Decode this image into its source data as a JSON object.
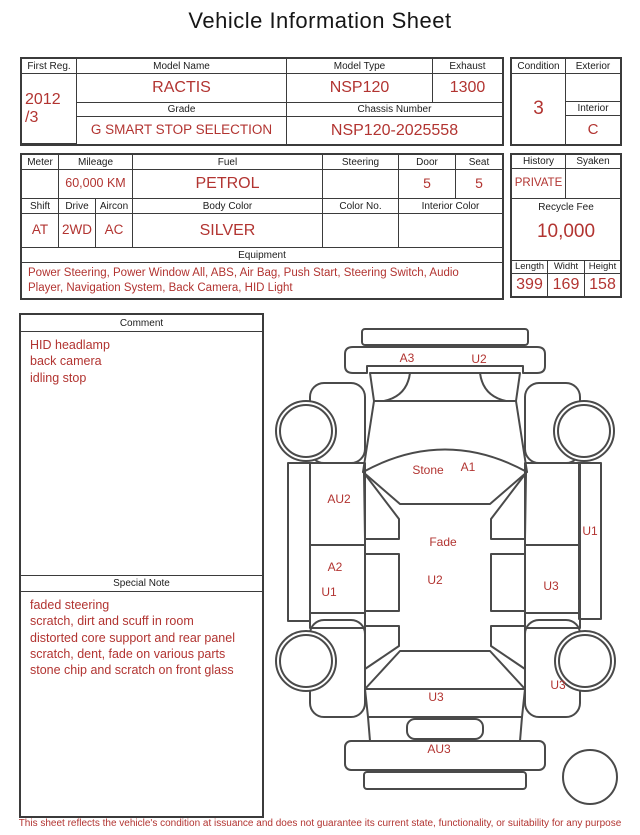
{
  "title": "Vehicle Information Sheet",
  "table1": {
    "first_reg": {
      "label": "First Reg.",
      "value": "2012\n/3"
    },
    "model_name": {
      "label": "Model Name",
      "value": "RACTIS"
    },
    "model_type": {
      "label": "Model Type",
      "value": "NSP120"
    },
    "exhaust": {
      "label": "Exhaust",
      "value": "1300"
    },
    "grade": {
      "label": "Grade",
      "value": "G SMART STOP SELECTION"
    },
    "chassis_number": {
      "label": "Chassis Number",
      "value": "NSP120-2025558"
    },
    "condition": {
      "label": "Condition",
      "value": "3"
    },
    "exterior": {
      "label": "Exterior",
      "value": ""
    },
    "interior": {
      "label": "Interior",
      "value": "C"
    }
  },
  "table2": {
    "meter": {
      "label": "Meter",
      "value": ""
    },
    "mileage": {
      "label": "Mileage",
      "value": "60,000 KM"
    },
    "fuel": {
      "label": "Fuel",
      "value": "PETROL"
    },
    "steering": {
      "label": "Steering",
      "value": ""
    },
    "door": {
      "label": "Door",
      "value": "5"
    },
    "seat": {
      "label": "Seat",
      "value": "5"
    },
    "shift": {
      "label": "Shift",
      "value": "AT"
    },
    "drive": {
      "label": "Drive",
      "value": "2WD"
    },
    "aircon": {
      "label": "Aircon",
      "value": "AC"
    },
    "body_color": {
      "label": "Body Color",
      "value": "SILVER"
    },
    "color_no": {
      "label": "Color No.",
      "value": ""
    },
    "interior_color": {
      "label": "Interior Color",
      "value": ""
    },
    "equipment": {
      "label": "Equipment",
      "value": "Power Steering, Power Window  All, ABS, Air Bag, Push Start, Steering Switch, Audio Player, Navigation System, Back Camera, HID Light"
    },
    "history": {
      "label": "History",
      "value": "PRIVATE"
    },
    "syaken": {
      "label": "Syaken",
      "value": ""
    },
    "recycle_fee": {
      "label": "Recycle Fee",
      "value": "10,000"
    },
    "length": {
      "label": "Length",
      "value": "399"
    },
    "width": {
      "label": "Widht",
      "value": "169"
    },
    "height": {
      "label": "Height",
      "value": "158"
    }
  },
  "comment": {
    "label": "Comment",
    "text": "HID headlamp\nback camera\nidling stop"
  },
  "special_note": {
    "label": "Special Note",
    "text": "faded steering\nscratch, dirt and scuff in room\ndistorted core support and rear panel\nscratch, dent, fade on various parts\nstone chip and scratch on front glass"
  },
  "diagram": {
    "marks": [
      {
        "label": "A3",
        "area": "front-bumper-left"
      },
      {
        "label": "U2",
        "area": "front-bumper-right"
      },
      {
        "label": "Stone",
        "area": "windshield"
      },
      {
        "label": "A1",
        "area": "windshield"
      },
      {
        "label": "AU2",
        "area": "left-front-door"
      },
      {
        "label": "Fade",
        "area": "roof"
      },
      {
        "label": "A2",
        "area": "left-rear-door"
      },
      {
        "label": "U2",
        "area": "roof-lower"
      },
      {
        "label": "U1",
        "area": "left-rear-door-lower"
      },
      {
        "label": "U1",
        "area": "right-sill"
      },
      {
        "label": "U3",
        "area": "right-rear-door"
      },
      {
        "label": "U3",
        "area": "right-rear-fender"
      },
      {
        "label": "U3",
        "area": "rear-window"
      },
      {
        "label": "AU3",
        "area": "rear-bumper"
      }
    ]
  },
  "footer": "This sheet reflects the vehicle's condition at issuance and does not guarantee its current state, functionality, or suitability for any purpose",
  "colors": {
    "accent_red": "#b23431",
    "border": "#3b3b3b",
    "car_outline": "#4a4a4a"
  }
}
